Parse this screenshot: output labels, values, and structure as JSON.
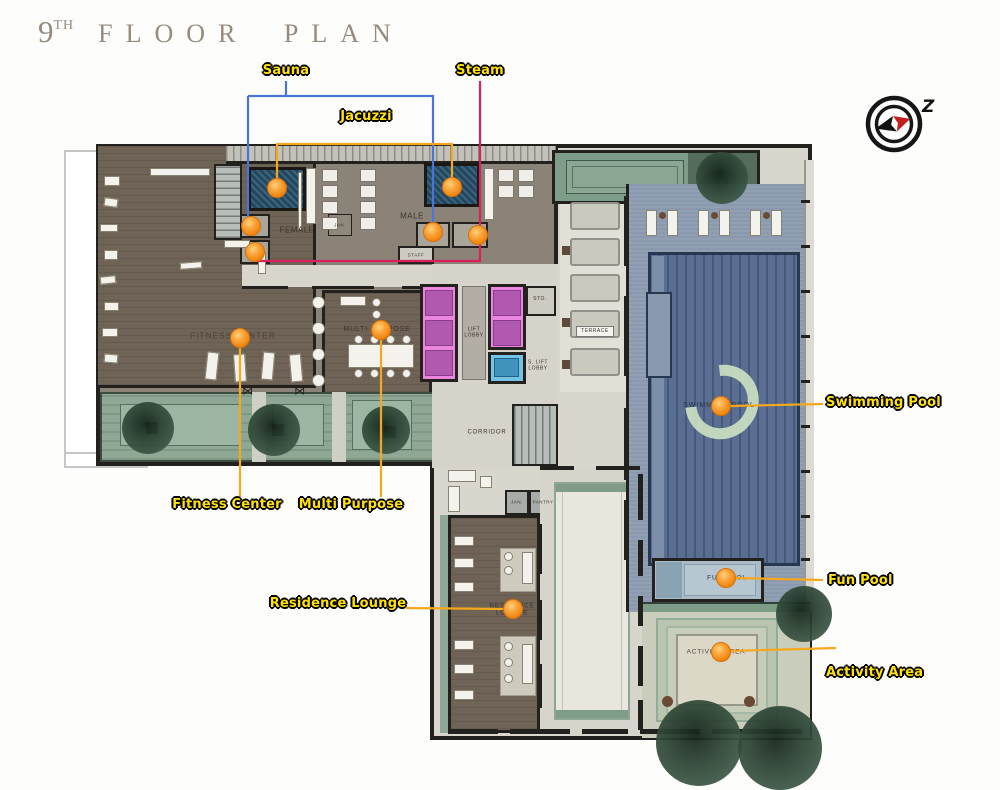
{
  "title": {
    "floor": "9",
    "ordinal": "TH",
    "name": "FLOOR PLAN"
  },
  "compass": {
    "north_mark": "Z"
  },
  "annotation_labels": {
    "sauna": "Sauna",
    "steam": "Steam",
    "jacuzzi": "Jacuzzi",
    "swimming_pool": "Swimming Pool",
    "fun_pool": "Fun Pool",
    "activity_area": "Activity Area",
    "fitness_center": "Fitness Center",
    "multi_purpose": "Multi Purpose",
    "residence_lounge": "Residence Lounge"
  },
  "room_labels": {
    "female": "FEMALE",
    "male": "MALE",
    "jan_locker": "JAN.",
    "staff": "STAFF",
    "fitness_center": "FITNESS CENTER",
    "multi_purpose": "MULTI PURPOSE",
    "lift_line1": "LIFT",
    "lift_line2": "LOBBY",
    "sto": "STO.",
    "s_lift_line1": "S. LIFT",
    "s_lift_line2": "LOBBY",
    "corridor": "CORRIDOR",
    "jan_lounge": "JAN.",
    "pantry": "PANTRY",
    "residence_line1": "RESIDENCE",
    "residence_line2": "LOUNGE",
    "terrace": "TERRACE",
    "swimming_pool": "SWIMMING POOL",
    "fun_pool": "FUN POOL",
    "activity_area": "ACTIVITY AREA"
  },
  "colors": {
    "label_text": "#ffe10a",
    "label_outline": "#000000",
    "marker_orange": "#f7941d",
    "line_blue": "#4a74d8",
    "line_crimson": "#d6215c",
    "line_orange": "#f6a81c",
    "wood_floor": "#6f6356",
    "locker_floor": "#8b8377",
    "pool_deck": "#8a99ae",
    "pool_water": "#54688b",
    "landscape_green": "#7e9d88",
    "elevator_pink": "#ea86dd",
    "service_lift_blue": "#74c3e4",
    "title_text": "#968b7d"
  }
}
